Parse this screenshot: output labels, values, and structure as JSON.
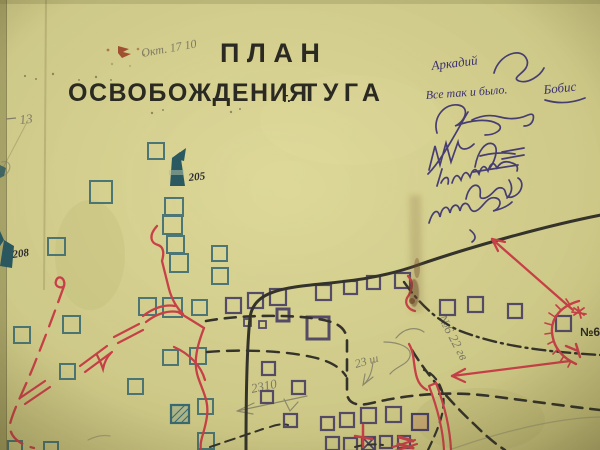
{
  "map": {
    "title_line1": "ПЛАН",
    "title_line2_word": "ОСВОБОЖДЕНИЯ",
    "title_city_prefix": "г.",
    "title_city_name": "ТУГА",
    "spot_height_a": "205",
    "spot_height_b": "208",
    "red_unit_label": "№6"
  },
  "pencil_notes": {
    "top_note": "Окт. 17 10",
    "left_margin_number": "13",
    "unit_note": "№6 22 гв",
    "distance_note_small": "23 ш",
    "distance_note_large": "2310"
  },
  "signatures": {
    "name_line": "Аркадий",
    "attestation": "Все так и было.",
    "surname": "Бобис"
  },
  "colors": {
    "paper": "#d9d493",
    "ink_black": "#34332c",
    "ink_teal": "#3a6b75",
    "ink_purple": "#4a4166",
    "ink_red": "#cc4149",
    "ink_signature": "#3b3174",
    "pencil_gray": "#84816c"
  },
  "symbols": [
    "watchtower-icon",
    "building-square-icon",
    "hatched-building-icon",
    "main-road-line",
    "dashed-track-line",
    "defense-arc-icon",
    "attack-arrow-icon",
    "signature-scribbles"
  ]
}
